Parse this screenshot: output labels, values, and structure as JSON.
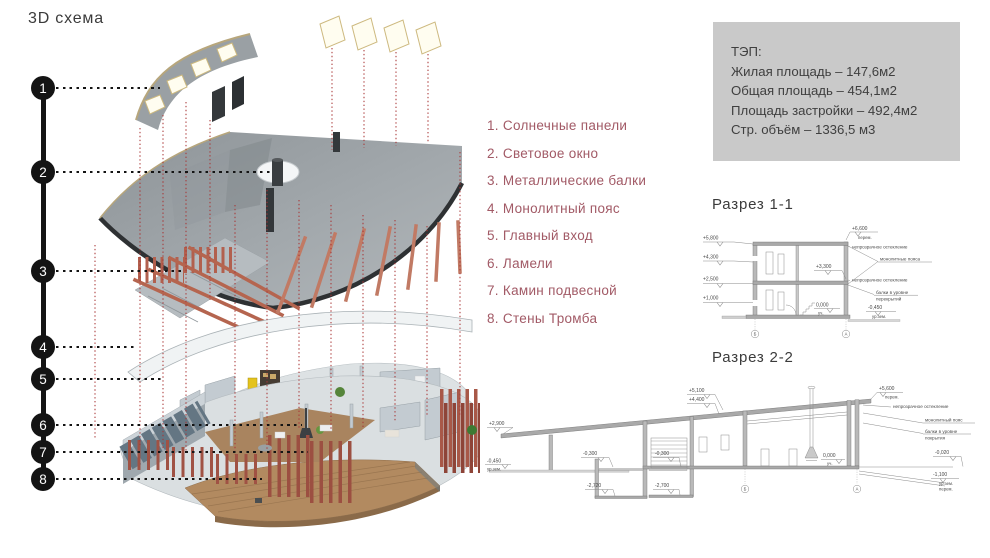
{
  "title": "3D схема",
  "callouts": {
    "numbers": [
      "1",
      "2",
      "3",
      "4",
      "5",
      "6",
      "7",
      "8"
    ]
  },
  "legend": {
    "items": [
      "1. Солнечные панели",
      "2. Световое окно",
      "3. Металлические балки",
      "4. Монолитный пояс",
      "5. Главный вход",
      "6. Ламели",
      "7. Камин подвесной",
      "8. Стены Тромба"
    ]
  },
  "tep": {
    "heading": "ТЭП:",
    "lines": [
      "Жилая площадь – 147,6м2",
      "Общая площадь – 454,1м2",
      "Площадь застройки – 492,4м2",
      "Стр. объём – 1336,5 м3"
    ]
  },
  "section1": {
    "title": "Разрез 1-1",
    "marks": {
      "l1": "+5,800",
      "l2": "+4,300",
      "l3": "+2,500",
      "l4": "+1,000",
      "top": "+6,600",
      "top_sub": "перем.",
      "mid": "+3,300",
      "zero": "0,000",
      "zero_sub": "уч.",
      "ground": "-0,450",
      "ground_sub": "ур.зем."
    },
    "labels": {
      "glazing1": "непрозрачное остекление",
      "belts": "монолитные пояса",
      "glazing2": "непрозрачное остекление",
      "beams1": "балки в уровне",
      "beams2": "перекрытий"
    },
    "axes": {
      "a": "Б",
      "b": "А"
    }
  },
  "section2": {
    "title": "Разрез 2-2",
    "marks": {
      "roof_left": "+2,900",
      "ground_left": "-0,450",
      "ground_left_sub": "ур.зем.",
      "roof1": "+5,100",
      "roof2": "+4,400",
      "top": "+5,600",
      "top_sub": "перем.",
      "base1": "-0,300",
      "base2": "-0,300",
      "pit1": "-2,720",
      "pit2": "-2,700",
      "zero": "0,000",
      "zero_sub": "уч.",
      "right1": "-0,020",
      "right2": "-1,100",
      "right2_sub1": "ур.зем.",
      "right2_sub2": "перем."
    },
    "labels": {
      "glazing": "непрозрачное остекление",
      "belt": "монолитный пояс",
      "beams1": "балки в уровне",
      "beams2": "покрытия"
    },
    "axes": {
      "a": "Б",
      "b": "А"
    }
  }
}
